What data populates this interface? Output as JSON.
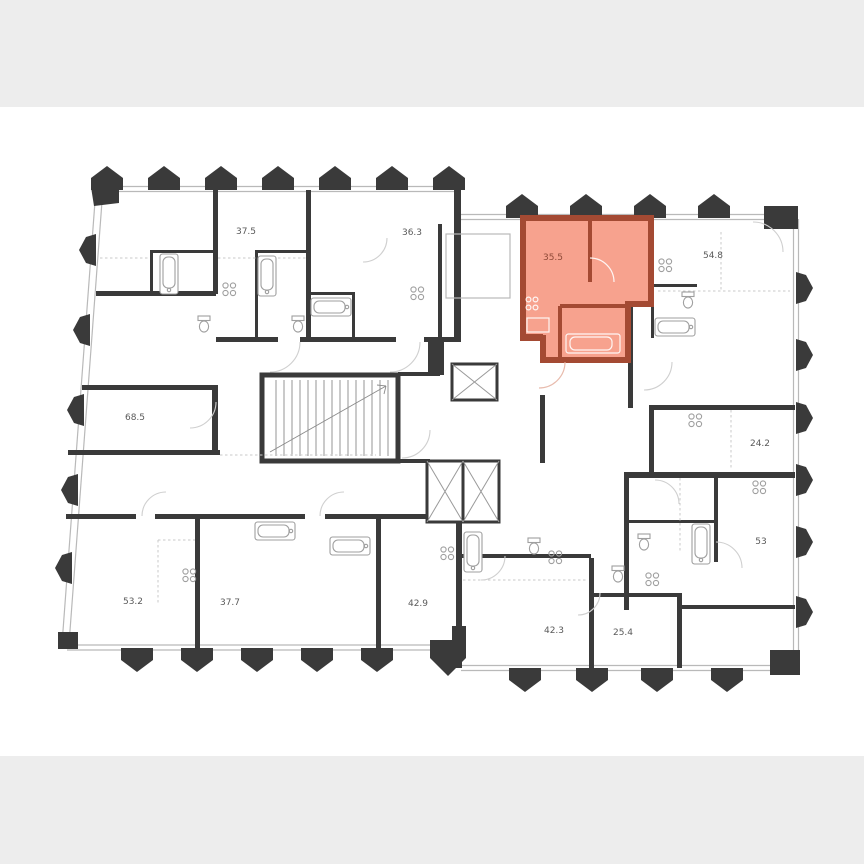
{
  "page": {
    "top_band_color": "#ededed",
    "bottom_band_color": "#ededed",
    "canvas_color": "#ffffff"
  },
  "floor_plan": {
    "wall_color": "#3a3a3a",
    "thin_line_color": "#b9b9b9",
    "label_color": "#5a5a5a",
    "units": [
      {
        "area": "37.5"
      },
      {
        "area": "36.3"
      },
      {
        "area": "54.8"
      },
      {
        "area": "68.5"
      },
      {
        "area": "24.2"
      },
      {
        "area": "53"
      },
      {
        "area": "53.2"
      },
      {
        "area": "37.7"
      },
      {
        "area": "42.9"
      },
      {
        "area": "42.3"
      },
      {
        "area": "25.4"
      }
    ],
    "highlighted_unit": {
      "area": "35.5",
      "fill_color": "#f7a28e",
      "wall_color": "#a44a33",
      "label_color": "#8f4a38"
    }
  }
}
